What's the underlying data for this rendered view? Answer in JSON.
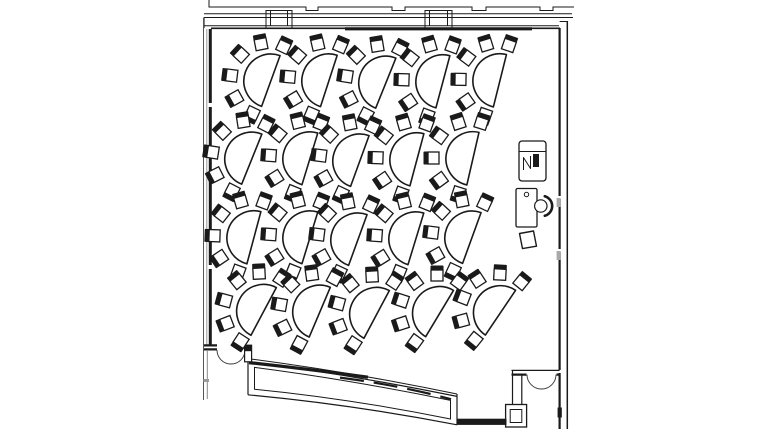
{
  "colors": {
    "line": "#1a1a1a",
    "line_soft": "#333333",
    "line_gray": "#9a9a9a",
    "bg": "#ffffff"
  },
  "canvas": {
    "w": 768,
    "h": 432
  },
  "room": {
    "wall_paths": [
      {
        "n": "exterior-outline-upper",
        "d": "M209 0 L209 7 L306 7 L306 10.5 L318 10.5 L318 7 L392 7 L392 10.5 L405 10.5 L405 7 L472 7 L472 10.5 L486 10.5 L486 7 L540 7 L540 10.5 L553 10.5 L553 7 L574 7",
        "w": 1
      },
      {
        "n": "exterior-outline-lower",
        "d": "M204 13.8 H572",
        "w": 1
      },
      {
        "n": "north-wall-top",
        "d": "M204 17.5 H573 M204 17.5 L204 28",
        "w": 1.1
      },
      {
        "n": "north-wall-bottom",
        "d": "M204 25.8 H559",
        "w": 1
      },
      {
        "n": "north-wall-inner-west",
        "d": "M211 28.3 H345",
        "w": 1.7
      },
      {
        "n": "north-wall-inner-dark",
        "d": "M345 28.8 H532",
        "w": 3.2
      },
      {
        "n": "north-wall-inner-east",
        "d": "M532 28.3 H560",
        "w": 1.7
      },
      {
        "n": "window-mullion-west",
        "d": "M266 29 V10.5 H292 V29 M270.5 10.5 V26 M287.5 10.5 V26",
        "w": 1
      },
      {
        "n": "window-mullion-east",
        "d": "M425 29 V10.5 H452 V29 M429.5 10.5 V26 M447.5 10.5 V26",
        "w": 1
      },
      {
        "n": "west-wall-outer",
        "d": "M203.5 17.5 V400",
        "w": 1,
        "c": "#555555"
      },
      {
        "n": "west-wall-mid",
        "d": "M206.8 29 V345",
        "w": 1,
        "c": "#9a9a9a"
      },
      {
        "n": "west-wall-inner",
        "d": "M210.3 29 V345",
        "w": 3,
        "dash": "74 4 64 4 90 4 300"
      },
      {
        "n": "east-wall-outer",
        "d": "M567.3 21 V429",
        "w": 1.5
      },
      {
        "n": "east-wall-inner",
        "d": "M559.6 28 V429",
        "w": 2.2,
        "dash": "168 3 50 3 118 3 400"
      },
      {
        "n": "east-wall-cap",
        "d": "M559.6 21.5 H567.3",
        "w": 1
      },
      {
        "n": "southeast-wall-top",
        "d": "M511.5 370.4 H559.6",
        "w": 1.2
      },
      {
        "n": "southeast-wall-bottom",
        "d": "M511.5 374.6 H526.5 M556.5 374.6 H559.6",
        "w": 2.2
      },
      {
        "n": "southeast-pier",
        "d": "M512.5 370.4 V404.5 M521.8 374.6 V404.5",
        "w": 1.2
      },
      {
        "n": "door-southeast-leaf-west",
        "d": "M527 374.6 A14.5 14.5 0 0 0 541.5 389",
        "w": 0.9,
        "c": "#333333"
      },
      {
        "n": "door-southeast-leaf-east",
        "d": "M556 374.6 A14.5 14.5 0 0 1 541.5 389",
        "w": 0.9,
        "c": "#333333"
      },
      {
        "n": "southwest-wall",
        "d": "M204 345.4 H217 M204 349.4 H217",
        "w": 2.2
      },
      {
        "n": "door-southwest-leaf-west",
        "d": "M217 350 A14 14 0 0 0 231 364",
        "w": 0.9,
        "c": "#333333"
      },
      {
        "n": "door-southwest-leaf-east",
        "d": "M245 350 A14 14 0 0 1 231 364",
        "w": 0.9,
        "c": "#333333"
      },
      {
        "n": "west-wall-lower-inner",
        "d": "M207.3 351 V399",
        "w": 1,
        "c": "#888888"
      },
      {
        "n": "curved-south-wall-top-outer",
        "d": "M248 358.6 Q350 371.8 457 394",
        "w": 1
      },
      {
        "n": "curved-south-wall-top-inner",
        "d": "M248 361.4 Q350 374.6 457 396.4",
        "w": 1.2
      },
      {
        "n": "curved-south-wall-top-dark",
        "d": "M249 362.6 Q305 368.6 368 377.2",
        "w": 3.2
      },
      {
        "n": "curved-south-wall-bottom",
        "d": "M457 424.8 Q350 404.2 248 394.8",
        "w": 1.2
      },
      {
        "n": "curved-south-wall-cap-west",
        "d": "M248 358.6 V394.8",
        "w": 1.2
      },
      {
        "n": "curved-south-wall-cap-east",
        "d": "M457 394 V424.8",
        "w": 1.2
      },
      {
        "n": "curved-south-wall-inner-outline",
        "d": "M254.5 367.4 Q350 379.8 450.5 400.4 L450.5 419 Q350 398.6 254.5 389.2 Z",
        "w": 1
      },
      {
        "n": "curved-south-wall-inner-dark-dash",
        "d": "M340 377.6 Q400 385.4 451 399.2",
        "w": 2.2,
        "dash": "24 10"
      }
    ],
    "wall_rects": [
      {
        "n": "southwest-door-jamb",
        "x": 244.6,
        "y": 345.2,
        "w": 7,
        "h": 16.6,
        "sw": 1.2,
        "f": "#ffffff"
      },
      {
        "n": "southwest-door-jamb-cap",
        "x": 244.6,
        "y": 345.2,
        "w": 7,
        "h": 6,
        "sw": 0,
        "f": "#1a1a1a"
      },
      {
        "n": "southeast-fixture-outer",
        "x": 505.6,
        "y": 404.5,
        "w": 21,
        "h": 22.5,
        "sw": 1.3,
        "f": "#ffffff"
      },
      {
        "n": "southeast-fixture-inner",
        "x": 510.2,
        "y": 409.5,
        "w": 11.6,
        "h": 13,
        "sw": 1,
        "f": "none"
      },
      {
        "n": "south-band-connector",
        "x": 457,
        "y": 419.2,
        "w": 49,
        "h": 5.2,
        "sw": 1,
        "f": "#1a1a1a"
      },
      {
        "n": "east-wall-tick-upper",
        "x": 556.6,
        "y": 198,
        "w": 4,
        "h": 9,
        "sw": 0,
        "f": "#a9a9a9"
      },
      {
        "n": "east-wall-tick-lower",
        "x": 556.6,
        "y": 251,
        "w": 4,
        "h": 9,
        "sw": 0,
        "f": "#a9a9a9"
      },
      {
        "n": "east-wall-tick-dark",
        "x": 557.6,
        "y": 407.5,
        "w": 4.2,
        "h": 10,
        "sw": 0,
        "f": "#1a1a1a"
      },
      {
        "n": "west-wall-lower-tick",
        "x": 203.5,
        "y": 379,
        "w": 5.5,
        "h": 3,
        "sw": 0,
        "f": "#9a9a9a"
      }
    ]
  },
  "furniture": {
    "av_cart": {
      "x": 519,
      "y": 141,
      "w": 27,
      "h": 40,
      "rx": 3,
      "divider_y": 151.5,
      "screen": {
        "x": 533,
        "y": 154,
        "w": 6,
        "h": 13
      },
      "mark": "M523.5 170 V157.5 L530.5 168.5 V156"
    },
    "desk": {
      "x": 516,
      "y": 188.5,
      "w": 21,
      "h": 38.5,
      "knob": {
        "cx": 526.5,
        "cy": 194.5,
        "r": 2.2
      }
    },
    "desk_chair": {
      "cx": 540.8,
      "cy": 206,
      "seat_r": 6.2,
      "back": "M544.8 196.2 A10.2 10.2 0 0 1 544.8 215.8"
    },
    "stool": {
      "d": "M519.5 233.5 L533.5 231 L536.5 246.2 L522.5 248.6 Z"
    }
  },
  "tables": {
    "count": 20,
    "rows": 4,
    "cols": 5,
    "radius": 27,
    "chair_ring_radius": 38,
    "chair_angles_deg": [
      -85,
      -121,
      -157,
      167,
      131,
      95
    ],
    "chair_seat": {
      "x": -6,
      "y": -4,
      "w": 12,
      "h": 11
    },
    "chair_back": {
      "x": -6.5,
      "y": -8.5,
      "w": 13,
      "h": 4.5
    },
    "table_shape": "M3 -27 A27 27 0 0 0 3 27 Z",
    "items": [
      {
        "x": 268,
        "y": 80,
        "r": 20
      },
      {
        "x": 326,
        "y": 80,
        "r": 18
      },
      {
        "x": 383,
        "y": 82,
        "r": 22
      },
      {
        "x": 440,
        "y": 81,
        "r": 15
      },
      {
        "x": 497,
        "y": 80,
        "r": 14
      },
      {
        "x": 249,
        "y": 158,
        "r": 22
      },
      {
        "x": 307,
        "y": 158,
        "r": 17
      },
      {
        "x": 357,
        "y": 160,
        "r": 20
      },
      {
        "x": 414,
        "y": 159,
        "r": 15
      },
      {
        "x": 470,
        "y": 158,
        "r": 13
      },
      {
        "x": 251,
        "y": 237,
        "r": 15
      },
      {
        "x": 307,
        "y": 237,
        "r": 17
      },
      {
        "x": 355,
        "y": 239,
        "r": 20
      },
      {
        "x": 413,
        "y": 238,
        "r": 17
      },
      {
        "x": 469,
        "y": 237,
        "r": 20
      },
      {
        "x": 261,
        "y": 310,
        "r": 28
      },
      {
        "x": 317,
        "y": 311,
        "r": 23
      },
      {
        "x": 374,
        "y": 313,
        "r": 28
      },
      {
        "x": 437,
        "y": 312,
        "r": 31
      },
      {
        "x": 498,
        "y": 311,
        "r": 34
      }
    ]
  }
}
